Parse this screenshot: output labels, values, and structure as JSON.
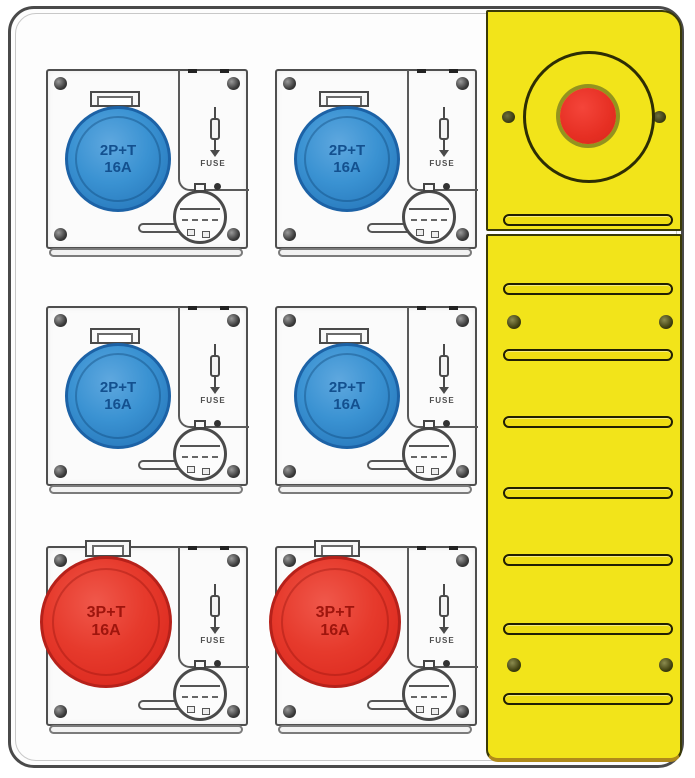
{
  "board": {
    "colors": {
      "enclosure": "#fdfdfd",
      "outline": "#4a4a4a",
      "side_panel_yellow": "#f2e41a",
      "socket_blue": "#3a92d2",
      "socket_red": "#e63a2c",
      "emergency_button_red": "#e62f23"
    },
    "modules": [
      {
        "id": "module-1",
        "socket_label": "2P+T",
        "rating": "16A",
        "fuse_label": "FUSE",
        "socket_color": "#3a92d2"
      },
      {
        "id": "module-2",
        "socket_label": "2P+T",
        "rating": "16A",
        "fuse_label": "FUSE",
        "socket_color": "#3a92d2"
      },
      {
        "id": "module-3",
        "socket_label": "2P+T",
        "rating": "16A",
        "fuse_label": "FUSE",
        "socket_color": "#3a92d2"
      },
      {
        "id": "module-4",
        "socket_label": "2P+T",
        "rating": "16A",
        "fuse_label": "FUSE",
        "socket_color": "#3a92d2"
      },
      {
        "id": "module-5",
        "socket_label": "3P+T",
        "rating": "16A",
        "fuse_label": "FUSE",
        "socket_color": "#e63a2c"
      },
      {
        "id": "module-6",
        "socket_label": "3P+T",
        "rating": "16A",
        "fuse_label": "FUSE",
        "socket_color": "#e63a2c"
      }
    ],
    "side_panel": {
      "vent_slot_count": 8,
      "screw_count": 4,
      "emergency_button": {
        "shape": "round",
        "color": "#e62f23"
      }
    },
    "icons": {
      "screw-icon": "filled-dark-circle",
      "fuse-icon": "vertical-line-through-rectangle-with-down-arrow",
      "vent-slot": "rounded-horizontal-slot",
      "emergency-stop-icon": "red-circle-inside-ring",
      "fuse-carrier-icon": "circle-with-horizontal-handle",
      "lid-tab-icon": "hinged-cover-tab"
    }
  }
}
